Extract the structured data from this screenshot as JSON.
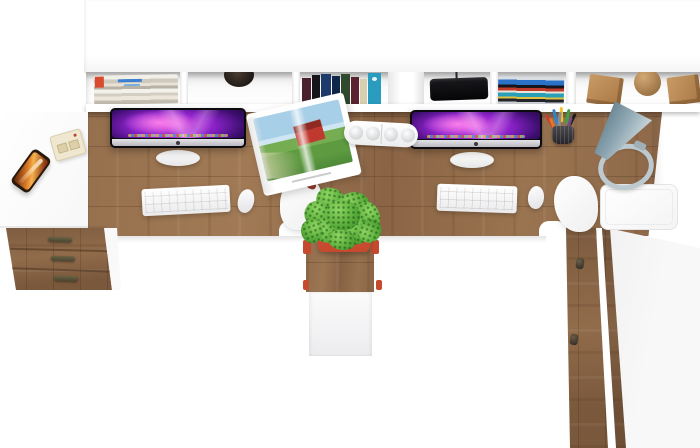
{
  "scene": {
    "subject": "top-down product photo of a two-person white workstation with oak desktop, hutch shelf, drawers, plant, lamp and two iMacs",
    "colors": {
      "floor_white": "#ffffff",
      "wood": "#96704e",
      "wood_dark": "#7c5a3e",
      "wood_decor": "#c89a66",
      "screen_magenta": "#cf44e2",
      "screen_deep_purple": "#1a0736",
      "plant_green": "#57ab39",
      "pot_red": "#c6492e",
      "lamp_grey_blue": "#8ba4b0",
      "phone_orange": "#e2812c",
      "barn_red": "#c0392e",
      "dvd_blue": "#2a72c8",
      "book_teal": "#2a9cc0",
      "handle_bronze": "#4a4632"
    },
    "objects": [
      "white-hutch-shelf",
      "magazine-stack",
      "round-cup",
      "book-row",
      "black-speaker",
      "dvd-stack",
      "wood-decor-cube",
      "wood-decor-sphere",
      "imac-left",
      "imac-right",
      "white-keyboard",
      "white-mouse",
      "open-magazine",
      "white-power-strip",
      "pencil-cup",
      "desk-lamp",
      "potted-plant",
      "smartphone",
      "beige-gadget",
      "drawer-pedestal",
      "middle-pedestal",
      "tall-cabinet",
      "office-chair",
      "white-side-table"
    ]
  }
}
